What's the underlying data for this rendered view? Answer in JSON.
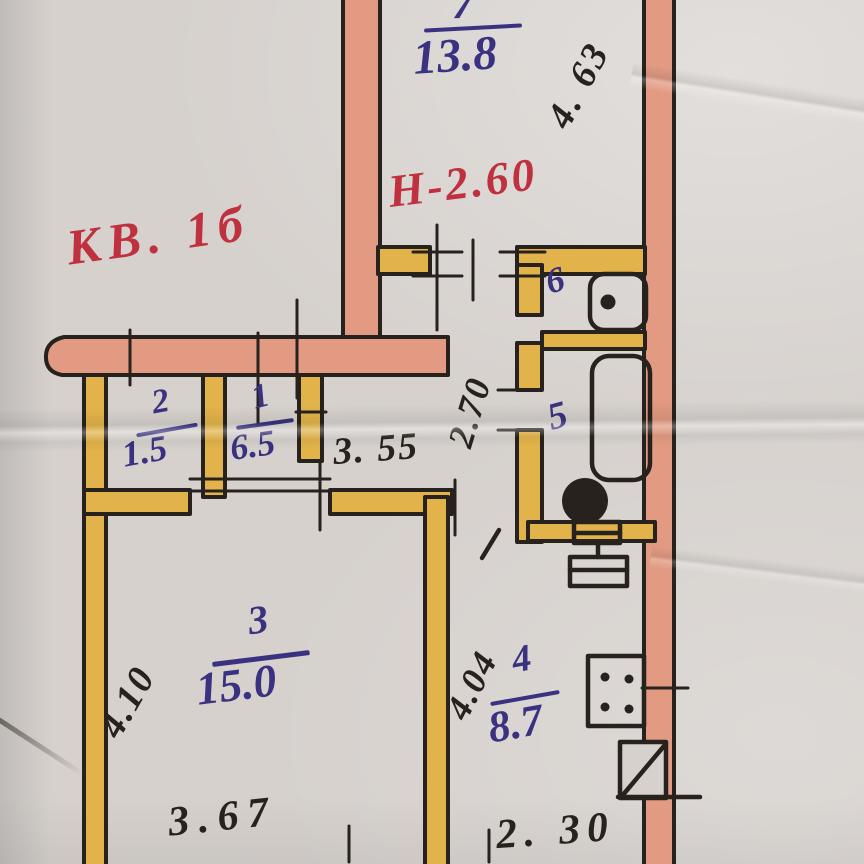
{
  "document": {
    "kind": "hand-drawn apartment floor plan (scanned paper)",
    "apartment_label": "КВ. 1б",
    "ceiling_height_note": "Н-2.60"
  },
  "rooms": {
    "r7": {
      "num": "7",
      "area": "13.8"
    },
    "r1": {
      "num": "1",
      "area": "6.5"
    },
    "r2": {
      "num": "2",
      "area": "1.5"
    },
    "r3": {
      "num": "3",
      "area": "15.0"
    },
    "r4": {
      "num": "4",
      "area": "8.7"
    },
    "r5": {
      "num": "5"
    },
    "r6": {
      "num": "6"
    }
  },
  "dims": {
    "d463": "4. 63",
    "d355": "3. 55",
    "d270": "2.70",
    "d410": "4.10",
    "d367": "3.67",
    "d404": "4.04",
    "d230": "2. 30"
  },
  "fixtures": [
    "washbasin-icon",
    "bathtub-icon",
    "toilet-icon",
    "kitchen-sink-icon",
    "stove-icon",
    "balcony-door-icon"
  ],
  "colors": {
    "paper": "#d6d1cd",
    "wall_bearing_pink": "#e29a82",
    "wall_partition_yellow": "#e2b34a",
    "ink_black": "#27221d",
    "ink_blue": "#3a3280",
    "ink_red": "#c0313f"
  }
}
